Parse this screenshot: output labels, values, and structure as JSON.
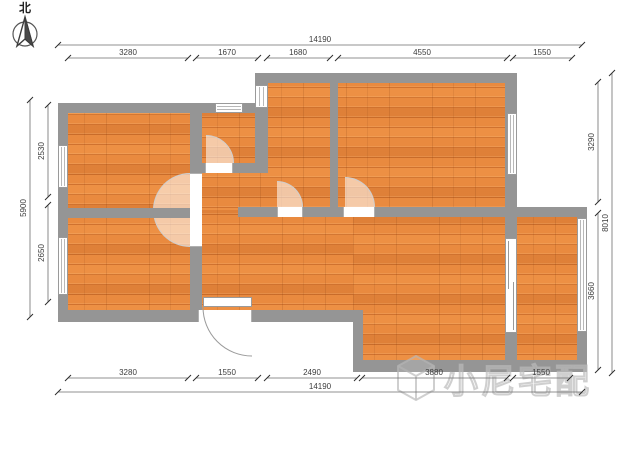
{
  "compass": {
    "label": "北"
  },
  "watermark": {
    "text": "小尼宅配",
    "logo": "cube-logo"
  },
  "dimensions": {
    "top": {
      "overall": "14190",
      "segments": [
        "3280",
        "1670",
        "1680",
        "4550",
        "1550"
      ]
    },
    "bottom": {
      "overall": "14190",
      "segments": [
        "3280",
        "1550",
        "2490",
        "3880",
        "1550"
      ]
    },
    "left": {
      "overall": "5900",
      "segments": [
        "2530",
        "2650"
      ]
    },
    "right": {
      "overall": "8010",
      "segments": [
        "3290",
        "3660"
      ]
    }
  },
  "colors": {
    "floor": "#e98a3f",
    "wall": "#959595",
    "dimension_text": "#3c3c3c",
    "watermark": "#c9c9c9"
  }
}
